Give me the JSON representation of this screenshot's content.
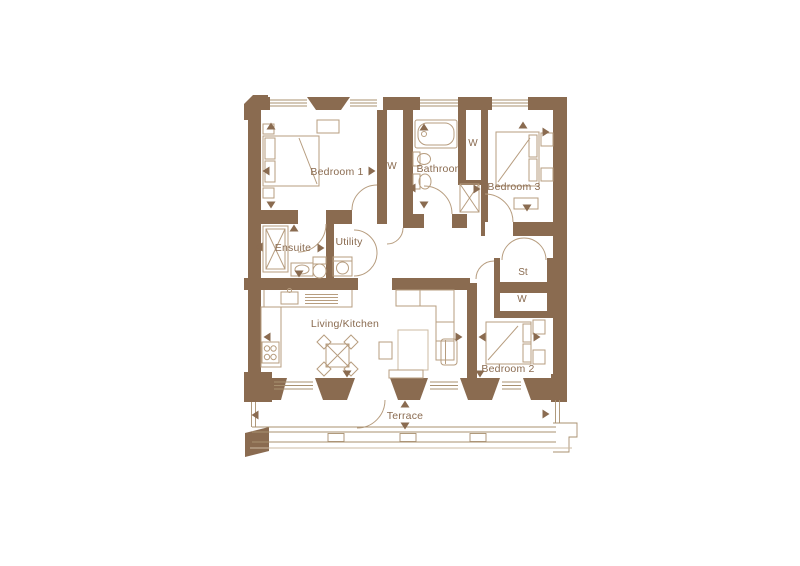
{
  "floorplan": {
    "title": "Apartment floor plan",
    "rooms": {
      "bedroom1": "Bedroom 1",
      "bathroom": "Bathroom",
      "bedroom3": "Bedroom 3",
      "ensuite": "Ensuite",
      "utility": "Utility",
      "living_kitchen": "Living/Kitchen",
      "bedroom2": "Bedroom 2",
      "terrace": "Terrace",
      "wardrobe1": "W",
      "wardrobe2": "W",
      "wardrobe3": "W",
      "store": "St"
    },
    "colors": {
      "wall": "#8a6b50",
      "furniture_line": "#b79d7f",
      "window_line": "#a8906f",
      "label_text": "#8a6b50",
      "background": "#ffffff"
    },
    "markers": {
      "dimension_arrow": "triangle-icon"
    }
  }
}
